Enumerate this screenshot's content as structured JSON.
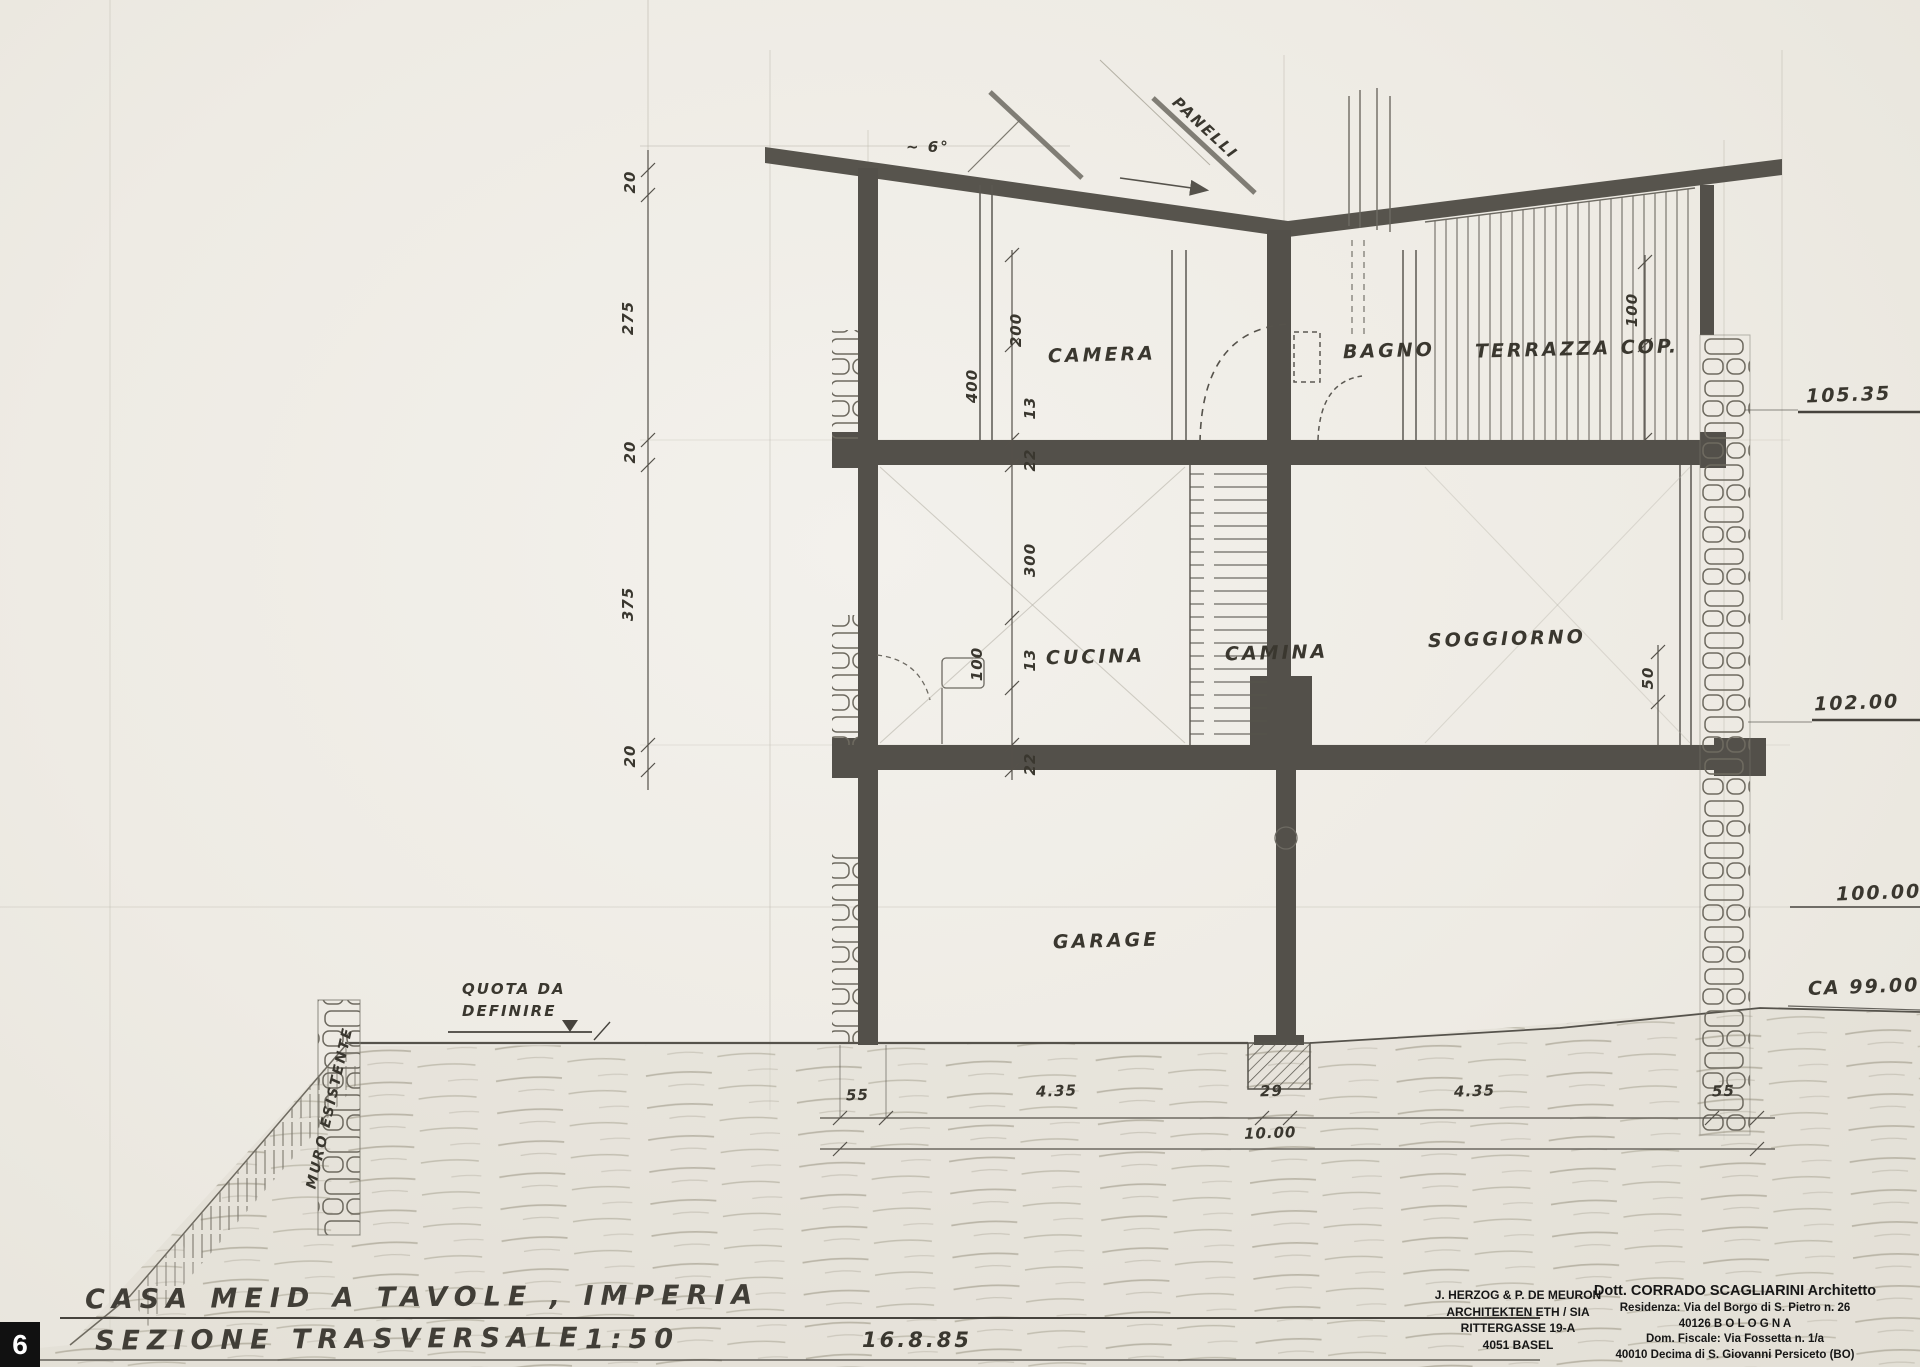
{
  "sheet": {
    "number": "6",
    "title": "CASA MEID A TAVOLE , IMPERIA",
    "subtitle": "SEZIONE TRASVERSALE",
    "scale": "1:50",
    "date": "16.8.85"
  },
  "rooms": {
    "camera": "CAMERA",
    "bagno": "BAGNO",
    "terrazza": "TERRAZZA COP.",
    "cucina": "CUCINA",
    "camina": "CAMINA",
    "soggiorno": "SOGGIORNO",
    "garage": "GARAGE"
  },
  "elevations": {
    "roof": "105.35",
    "main_floor": "102.00",
    "datum": "100.00",
    "ground": "CA 99.00"
  },
  "dims": {
    "left": [
      "20",
      "275",
      "20",
      "375",
      "20"
    ],
    "upper": {
      "h_total": "400",
      "h_room": "200",
      "t1": "13",
      "t2": "22",
      "right": "100"
    },
    "lower": {
      "h_total": "300",
      "h_part": "100",
      "t1": "13",
      "t2": "22",
      "right": "50"
    },
    "bottom": [
      "55",
      "4.35",
      "29",
      "4.35",
      "55"
    ],
    "bottom_total": "10.00"
  },
  "notes": {
    "roof_angle": "~ 6°",
    "panels": "PANELLI",
    "quota_line1": "QUOTA DA",
    "quota_line2": "DEFINIRE",
    "muro": "MURO ESISTENTE"
  },
  "stamps": {
    "herzog": {
      "l1": "J. HERZOG & P. DE MEURON",
      "l2": "ARCHITEKTEN ETH / SIA",
      "l3": "RITTERGASSE 19-A",
      "l4": "4051 BASEL"
    },
    "scagliarini": {
      "l1": "Dott. CORRADO SCAGLIARINI Architetto",
      "l2": "Residenza: Via del Borgo di S. Pietro n. 26",
      "l3": "40126  B O L O G N A",
      "l4": "Dom. Fiscale: Via Fossetta n. 1/a",
      "l5": "40010 Decima di S. Giovanni Persiceto (BO)"
    }
  },
  "colors": {
    "paper": "#efede7",
    "ink": "#4b4842",
    "pencil": "#8f8b80",
    "text": "#3a372f"
  }
}
